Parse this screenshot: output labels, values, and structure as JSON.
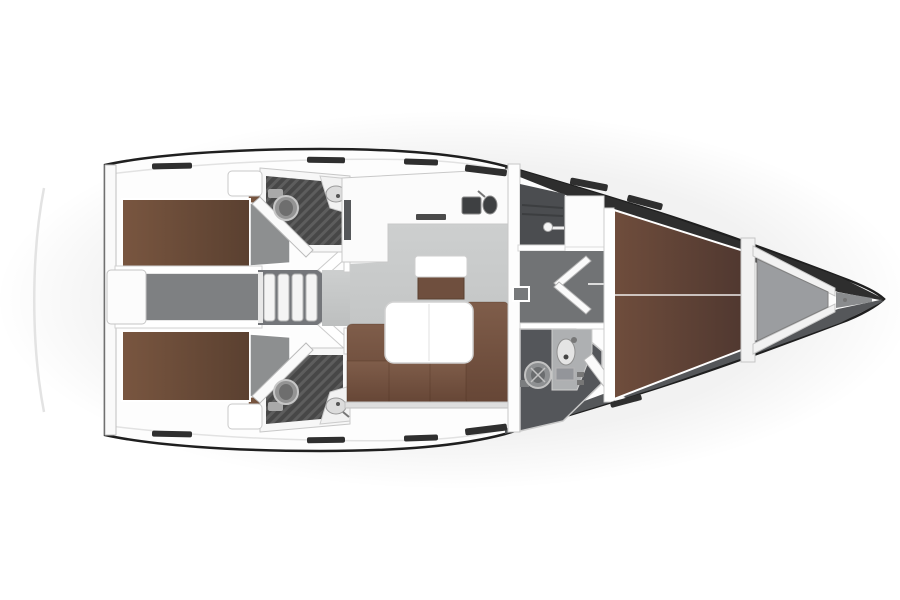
{
  "layout": {
    "type": "sailing-yacht-floor-plan",
    "view": "top-down",
    "bow_direction": "right",
    "rooms": [
      {
        "id": "aft-cabin-port",
        "berths": 1
      },
      {
        "id": "aft-cabin-starboard",
        "berths": 1
      },
      {
        "id": "engine-compartment"
      },
      {
        "id": "aft-head-port",
        "features": [
          "toilet",
          "sink",
          "shower-grate-floor",
          "angled-door"
        ]
      },
      {
        "id": "aft-head-starboard",
        "features": [
          "toilet",
          "sink",
          "shower-grate-floor",
          "angled-door"
        ]
      },
      {
        "id": "companionway",
        "steps": 4
      },
      {
        "id": "galley",
        "features": [
          "l-shaped-counter",
          "double-sink"
        ]
      },
      {
        "id": "salon",
        "features": [
          "l-shaped-sofa",
          "folding-table",
          "stool"
        ]
      },
      {
        "id": "wardrobe",
        "features": [
          "hanging-rail"
        ]
      },
      {
        "id": "forward-head",
        "features": [
          "toilet",
          "sink",
          "counter",
          "angled-door"
        ]
      },
      {
        "id": "forward-cabin",
        "berths": 1,
        "berth_style": "v-berth"
      },
      {
        "id": "anchor-locker"
      }
    ]
  },
  "colors": {
    "hull_outline": "#1f1f1f",
    "wall_stroke": "#c8c8c8",
    "berth_brown": "#795640",
    "berth_brown_dark": "#5a4030",
    "fwd_berth_brown": "#6f4d3c",
    "fwd_berth_brown_dark": "#503830",
    "sofa_brown": "#7f5d4a",
    "sofa_brown_dark": "#664636",
    "stool_brown": "#6f4f3e",
    "salon_floor": "#c9cbcb",
    "corridor_gray": "#717375",
    "engine_gray": "#7e8082",
    "foot_gray": "#8d8f90",
    "dark_room": "#4b4d50",
    "head_floor": "#54565a",
    "hatch_floor": "#474747",
    "hatch_stripe": "#5d5d5d",
    "sink_dark": "#3e4042",
    "fixture_mid": "#949494",
    "anchor_locker": "#9b9da0",
    "bow_shade_top": "#2e2e2e",
    "bow_shade_bottom": "#55575a",
    "window_dark": "#2f2f2f",
    "deck_white": "#fdfdfd"
  }
}
